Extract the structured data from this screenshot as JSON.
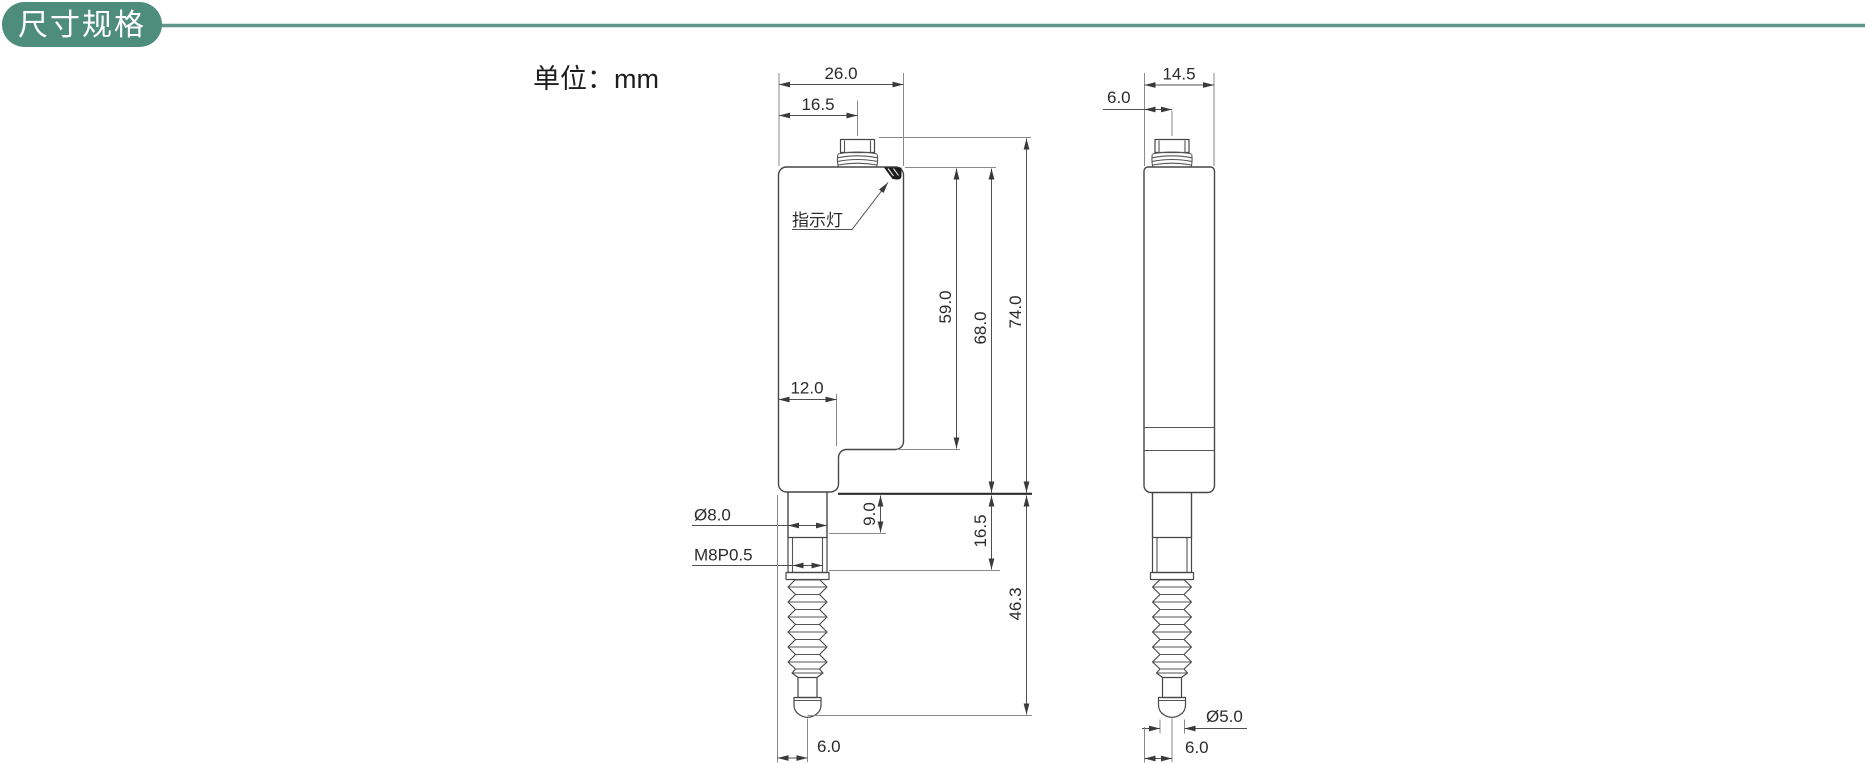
{
  "header": {
    "title": "尺寸规格"
  },
  "units_label": "单位：mm",
  "colors": {
    "accent": "#4e8d7c",
    "accent_line": "#5f958a",
    "line": "#4a4a4a",
    "text": "#2b2b2b"
  },
  "front_view": {
    "indicator_label": "指示灯",
    "dims": {
      "overall_width": "26.0",
      "connector_offset": "16.5",
      "head_height": "59.0",
      "body_height": "68.0",
      "overall_height": "74.0",
      "column_width": "12.0",
      "spindle_diameter": "Ø8.0",
      "thread_spec": "M8P0.5",
      "spindle_neck_length": "9.0",
      "thread_length_from_body": "16.5",
      "travel_length": "46.3",
      "spindle_center_offset": "6.0"
    }
  },
  "side_view": {
    "dims": {
      "overall_depth": "14.5",
      "connector_center_offset": "6.0",
      "tip_diameter": "Ø5.0",
      "spindle_center_offset": "6.0"
    }
  }
}
